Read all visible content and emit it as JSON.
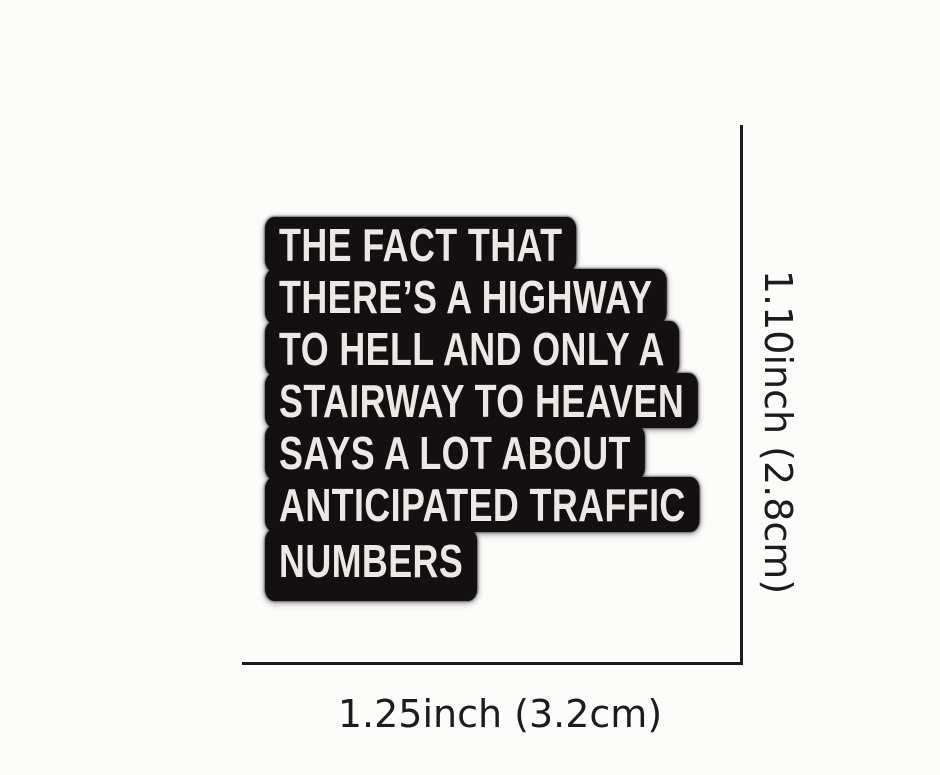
{
  "pin": {
    "description": "black enamel pin with white block lettering",
    "lines": [
      "THE FACT THAT",
      "THERE’S A HIGHWAY",
      "TO HELL AND ONLY A",
      "STAIRWAY TO HEAVEN",
      "SAYS A LOT ABOUT",
      "ANTICIPATED TRAFFIC",
      "NUMBERS"
    ]
  },
  "dimensions": {
    "height_label": "1.10inch (2.8cm)",
    "width_label": "1.25inch (3.2cm)"
  },
  "colors": {
    "background": "#fcfcfa",
    "pin_body": "#141011",
    "pin_text": "#ebe9e6",
    "pin_rim": "#7a7a7a",
    "dimension_line": "#1b1b1b",
    "dimension_text": "#1c1c1c"
  }
}
